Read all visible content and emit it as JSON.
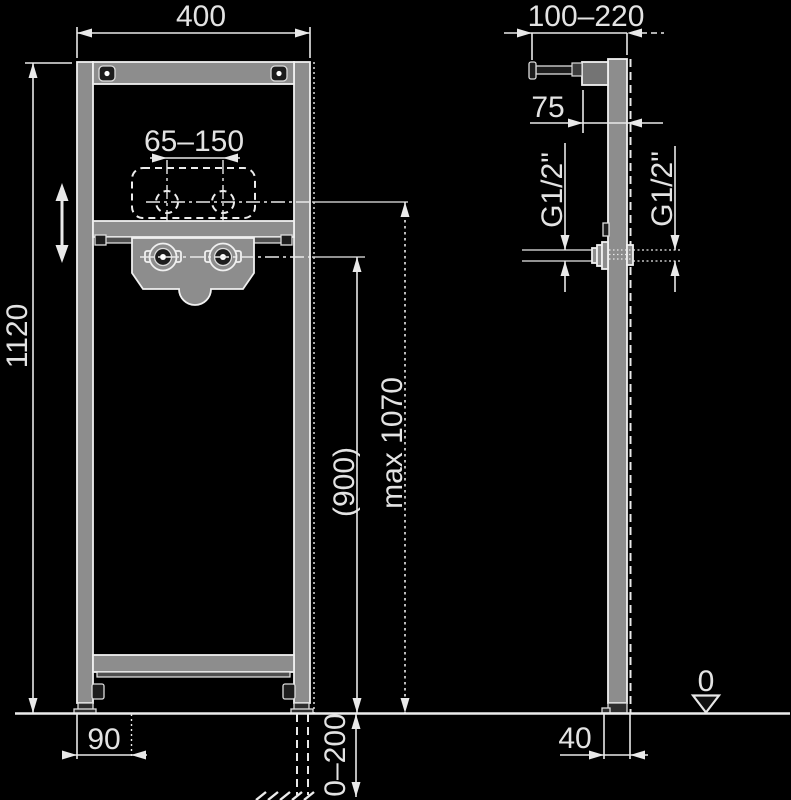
{
  "drawing": {
    "kind": "mounting-frame installation diagram",
    "colors": {
      "background": "#000000",
      "line": "#e9e9e9",
      "metal_gray": "#8d8d8d",
      "bracket_gray": "#747474",
      "text": "#e3e3e3"
    },
    "front_view": {
      "dim_width_top": "400",
      "dim_height_left": "1120",
      "dim_tap_centers": "65–150",
      "dim_connection_height": "(900)",
      "dim_max_height": "max 1070",
      "dim_foot_offset": "90",
      "dim_leg_adjust": "0–200"
    },
    "side_view": {
      "dim_depth_top": "100–220",
      "dim_bracket_depth": "75",
      "thread_left": "G1/2\"",
      "thread_right": "G1/2\"",
      "dim_foot_depth": "40",
      "floor_datum": "0"
    }
  }
}
